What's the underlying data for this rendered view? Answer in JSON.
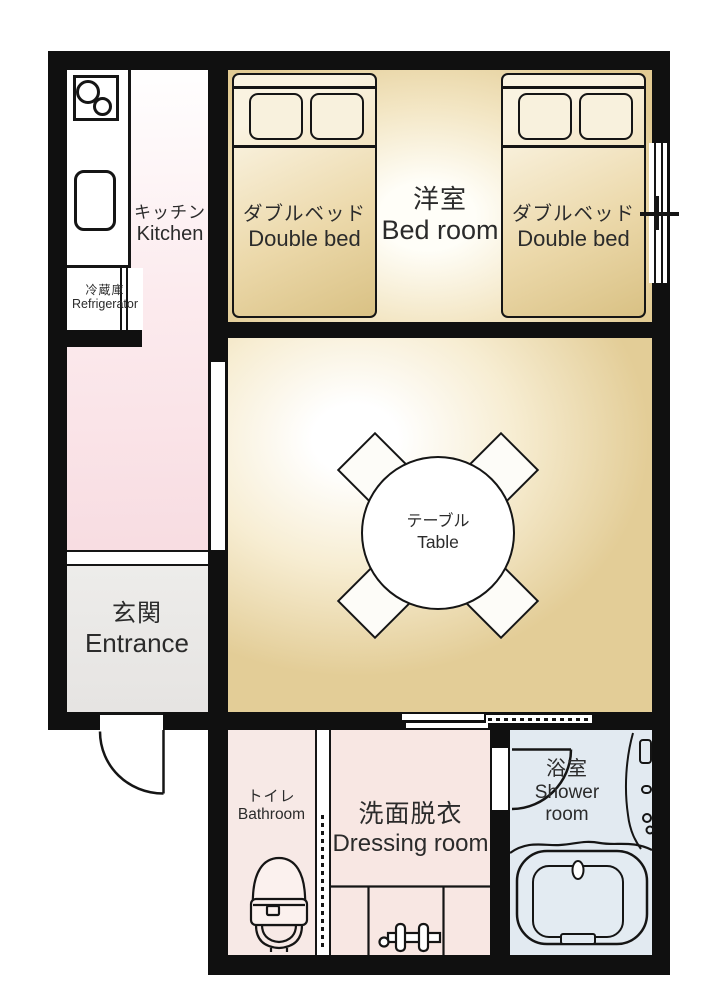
{
  "title": "apartment-floor-plan",
  "rooms": {
    "kitchen": {
      "jp": "キッチン",
      "en": "Kitchen"
    },
    "refrigerator": {
      "jp": "冷蔵庫",
      "en": "Refrigerator"
    },
    "bedroom": {
      "jp": "洋室",
      "en": "Bed room"
    },
    "double_bed": {
      "jp": "ダブルベッド",
      "en": "Double bed"
    },
    "table": {
      "jp": "テーブル",
      "en": "Table"
    },
    "entrance": {
      "jp": "玄関",
      "en": "Entrance"
    },
    "toilet": {
      "jp": "トイレ",
      "en": "Bathroom"
    },
    "dressing": {
      "jp": "洗面脱衣",
      "en": "Dressing room"
    },
    "shower": {
      "jp": "浴室",
      "en": "Shower room"
    }
  },
  "colors": {
    "wall": "#101010",
    "kitchen_floor": "#f8dde2",
    "bedroom_floor": "#e2cb93",
    "living_floor": "#e3cd97",
    "bed_fill": "#e8d5a4",
    "entrance_floor": "#eae8e6",
    "toilet_floor": "#f7e9e6",
    "dressing_floor": "#f8e7e3",
    "shower_floor": "#e2eaf1"
  }
}
